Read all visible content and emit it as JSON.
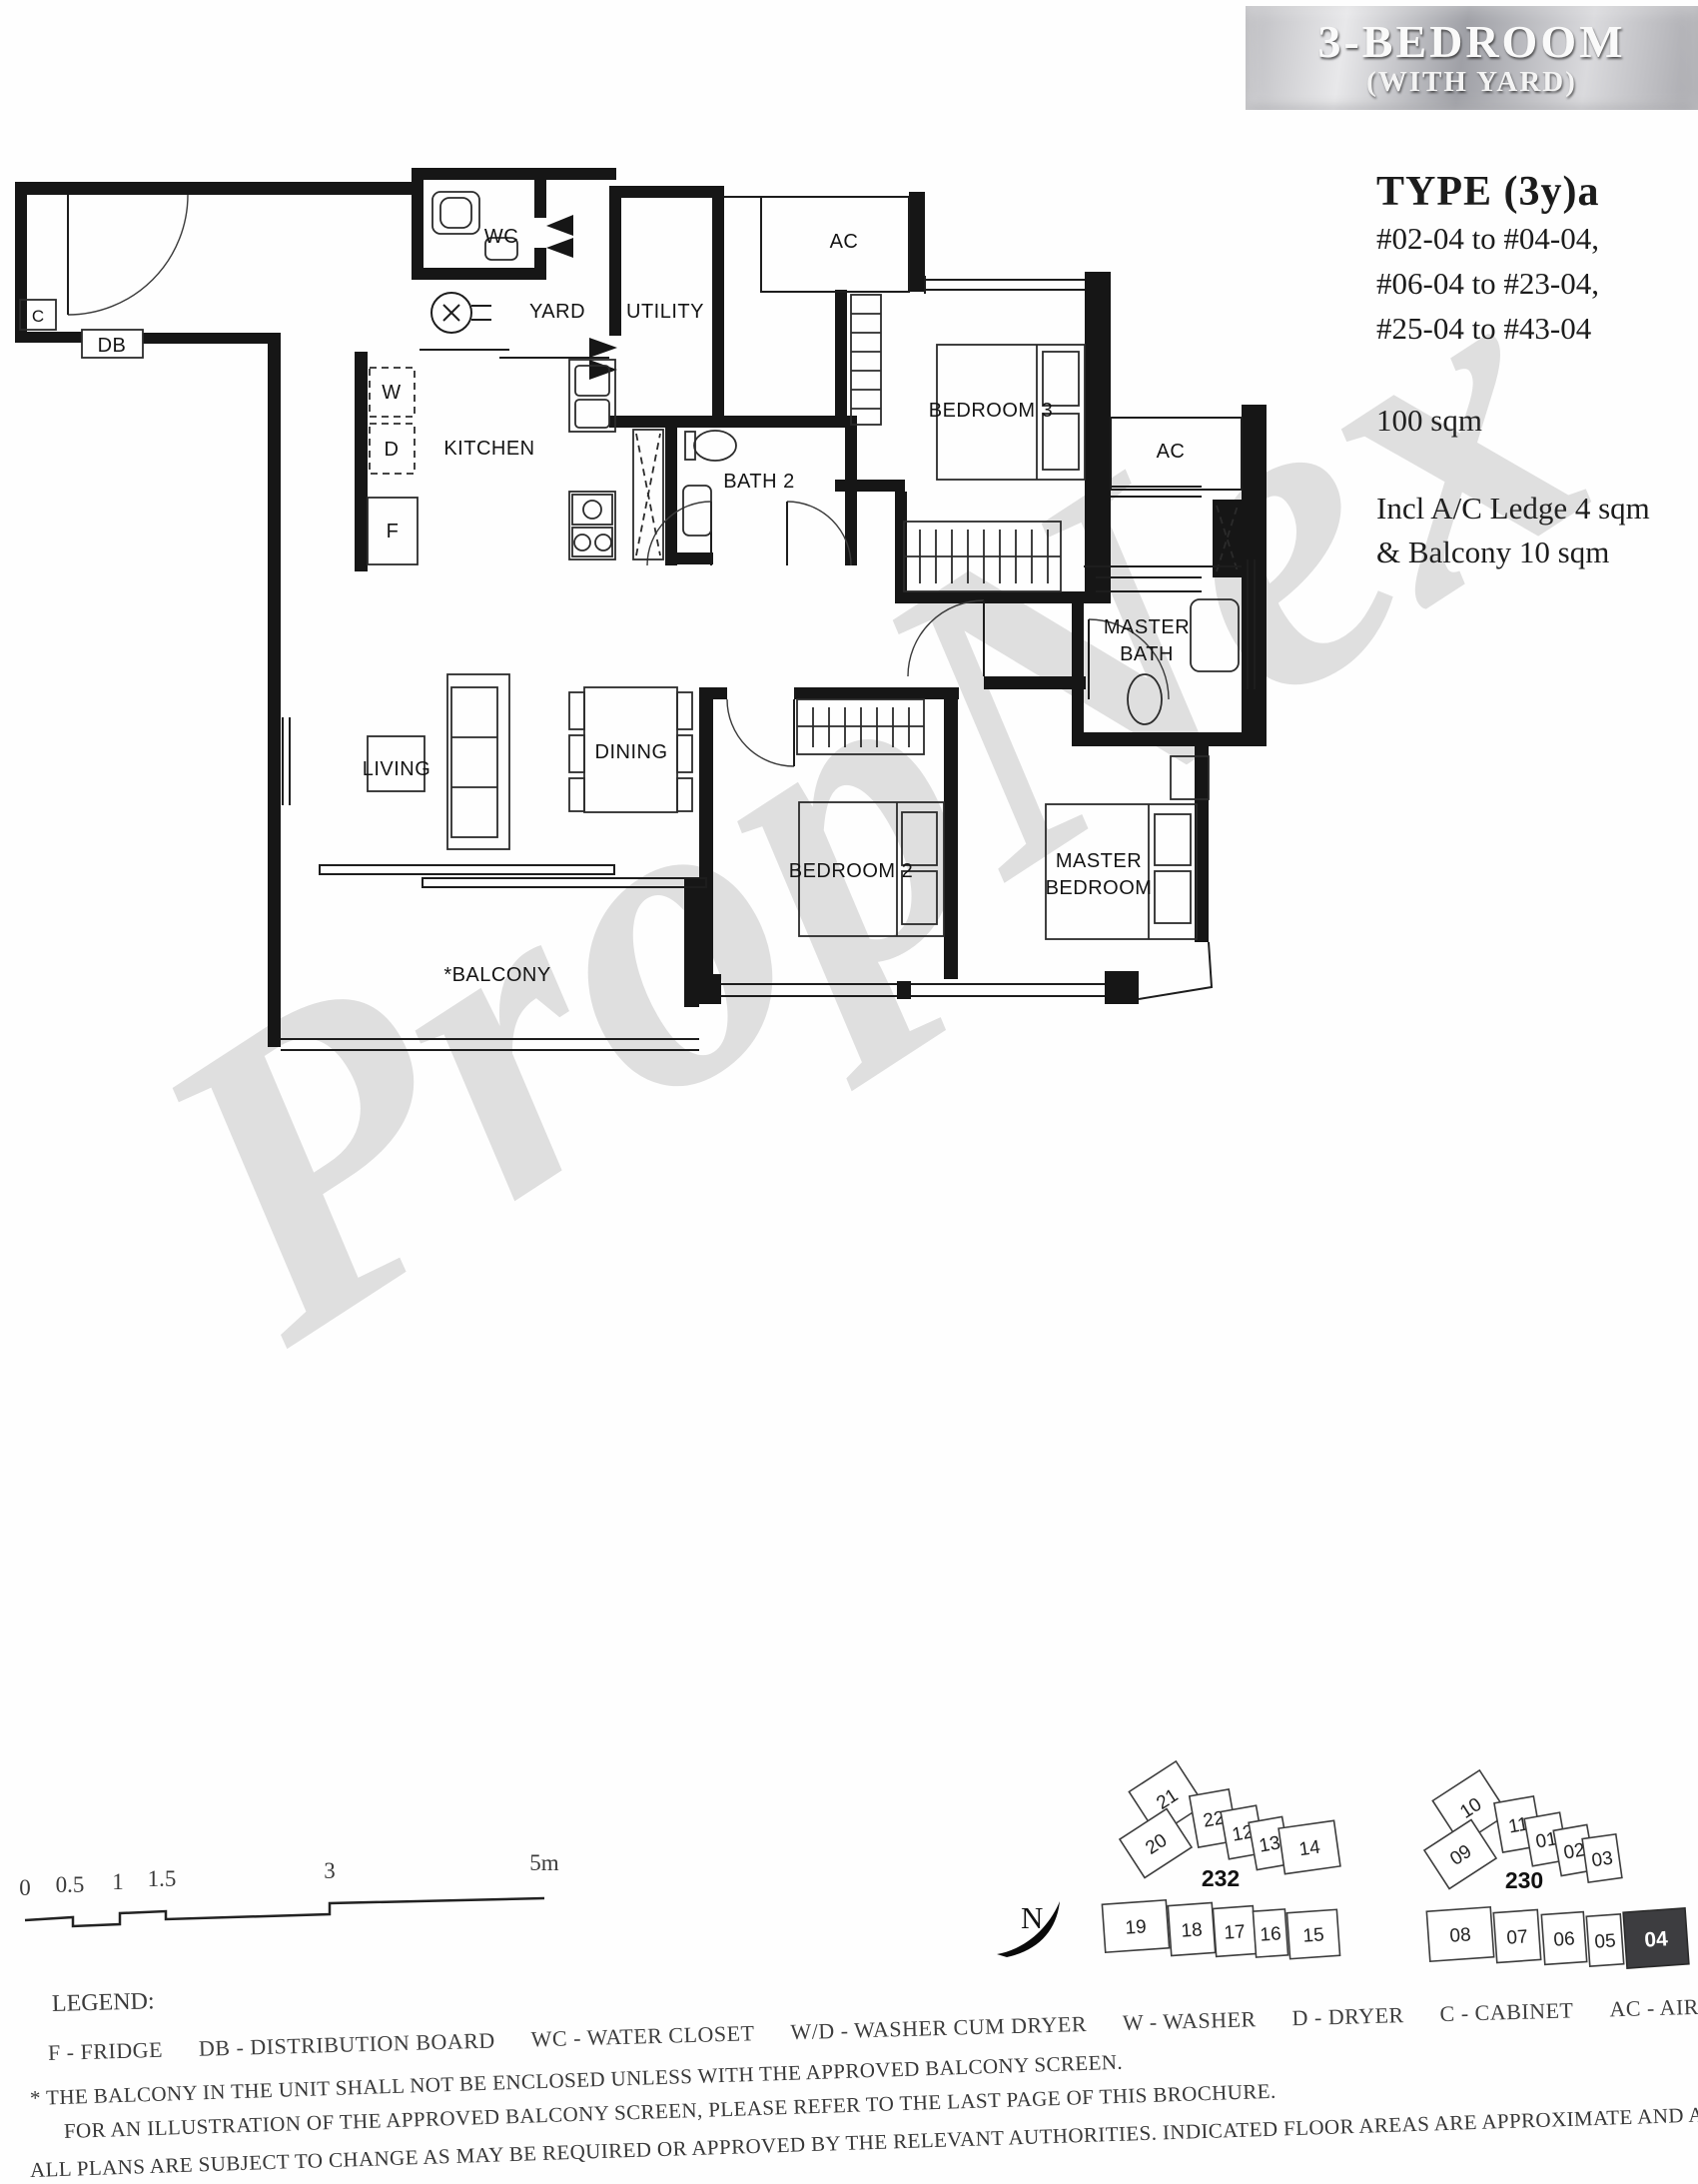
{
  "header": {
    "title": "3-BEDROOM",
    "subtitle": "(WITH YARD)"
  },
  "unit_info": {
    "type_label": "TYPE (3y)a",
    "stacks": [
      "#02-04 to #04-04,",
      "#06-04 to #23-04,",
      "#25-04 to #43-04"
    ],
    "area": "100 sqm",
    "inclusion_lines": [
      "Incl A/C Ledge 4 sqm",
      "& Balcony 10 sqm"
    ]
  },
  "watermark": {
    "text": "PropNex"
  },
  "floor_plan": {
    "rooms": {
      "wc": "WC",
      "yard": "YARD",
      "utility": "UTILITY",
      "kitchen": "KITCHEN",
      "bath2": "BATH 2",
      "bedroom3": "BEDROOM 3",
      "ac_top": "AC",
      "ac_right": "AC",
      "master_bath_line1": "MASTER",
      "master_bath_line2": "BATH",
      "living": "LIVING",
      "dining": "DINING",
      "balcony": "*BALCONY",
      "bedroom2": "BEDROOM 2",
      "master_bedroom_line1": "MASTER",
      "master_bedroom_line2": "BEDROOM",
      "db": "DB",
      "cabinet": "C",
      "washer": "W",
      "dryer": "D",
      "fridge": "F"
    }
  },
  "scale_bar": {
    "ticks": [
      "0",
      "0.5",
      "1",
      "1.5",
      "3",
      "5m"
    ]
  },
  "north": {
    "label": "N"
  },
  "key_plans": [
    {
      "block": "232",
      "top_units": [
        "21",
        "20",
        "22",
        "12",
        "13",
        "14"
      ],
      "bottom_units": [
        "19",
        "18",
        "17",
        "16",
        "15"
      ]
    },
    {
      "block": "230",
      "top_units": [
        "10",
        "09",
        "11",
        "01",
        "02",
        "03"
      ],
      "bottom_units": [
        "08",
        "07",
        "06",
        "05",
        "04"
      ],
      "highlighted": "04"
    }
  ],
  "legend": {
    "label": "LEGEND:",
    "items": [
      "F - FRIDGE",
      "DB - DISTRIBUTION BOARD",
      "WC - WATER CLOSET",
      "W/D - WASHER CUM DRYER",
      "W - WASHER",
      "D - DRYER",
      "C - CABINET",
      "AC - AIRCON LEDGE"
    ]
  },
  "footnotes": [
    "* THE BALCONY IN THE UNIT SHALL NOT BE ENCLOSED UNLESS WITH THE APPROVED BALCONY SCREEN.",
    "FOR AN ILLUSTRATION OF THE APPROVED BALCONY SCREEN, PLEASE REFER TO THE LAST PAGE OF THIS BROCHURE.",
    "ALL PLANS ARE SUBJECT TO CHANGE AS MAY BE REQUIRED OR APPROVED BY THE RELEVANT AUTHORITIES. INDICATED FLOOR AREAS ARE APPROXIMATE AND ARE SUBJECT TO FINAL SURVEY."
  ]
}
